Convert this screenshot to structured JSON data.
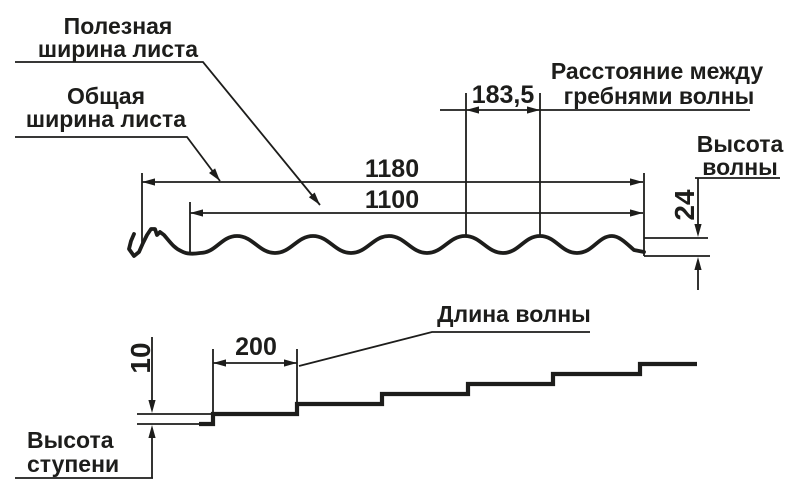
{
  "diagram": {
    "title_implicit": "Профиль листа металлочерепицы",
    "colors": {
      "ink": "#1d1d1b",
      "background": "#ffffff"
    },
    "labels": {
      "useful_width_line1": "Полезная",
      "useful_width_line2": "ширина листа",
      "overall_width_line1": "Общая",
      "overall_width_line2": "ширина листа",
      "crest_distance_line1": "Расстояние между",
      "crest_distance_line2": "гребнями волны",
      "wave_height_line1": "Высота",
      "wave_height_line2": "волны",
      "wave_length": "Длина волны",
      "step_height_line1": "Высота",
      "step_height_line2": "ступени"
    },
    "dimensions": {
      "overall_width": "1180",
      "useful_width": "1100",
      "crest_distance": "183,5",
      "wave_height": "24",
      "wave_length": "200",
      "step_height": "10"
    }
  }
}
